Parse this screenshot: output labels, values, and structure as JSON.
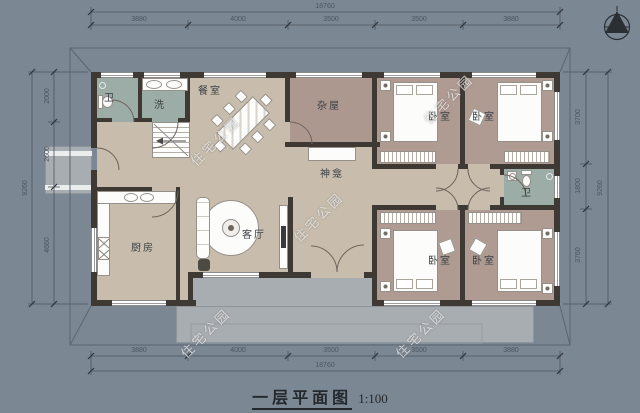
{
  "title": {
    "text": "一层平面图",
    "scale": "1:100"
  },
  "watermark": {
    "text": "住宅公园"
  },
  "rooms": {
    "bath_top_left": {
      "label": "卫"
    },
    "laundry": {
      "label": "洗"
    },
    "dining": {
      "label": "餐室"
    },
    "storage": {
      "label": "杂屋"
    },
    "shrine": {
      "label": "神龛"
    },
    "bedroom_ne_left": {
      "label": "卧室"
    },
    "bedroom_ne_right": {
      "label": "卧室"
    },
    "bath_right": {
      "label": "卫"
    },
    "kitchen": {
      "label": "厨房"
    },
    "living": {
      "label": "客厅"
    },
    "bedroom_se_left": {
      "label": "卧室"
    },
    "bedroom_se_right": {
      "label": "卧室"
    }
  },
  "dimensions": {
    "top": {
      "total": "18760",
      "segments": [
        "3880",
        "4000",
        "3500",
        "3500",
        "3880"
      ]
    },
    "bottom": {
      "total": "18760",
      "segments": [
        "3880",
        "4000",
        "3500",
        "3500",
        "3880"
      ]
    },
    "left": {
      "total": "9260",
      "segments": [
        "2000",
        "2600",
        "4660"
      ]
    },
    "right": {
      "total": "9260",
      "segments": [
        "3700",
        "1800",
        "3760"
      ]
    }
  },
  "palette": {
    "background": "#7b8793",
    "floor_main": "#c8bdac",
    "floor_bedroom": "#b09b93",
    "floor_storage": "#ad9890",
    "floor_bath": "#9cada8",
    "wall": "#3e3933",
    "porch": "#a8adb2"
  }
}
